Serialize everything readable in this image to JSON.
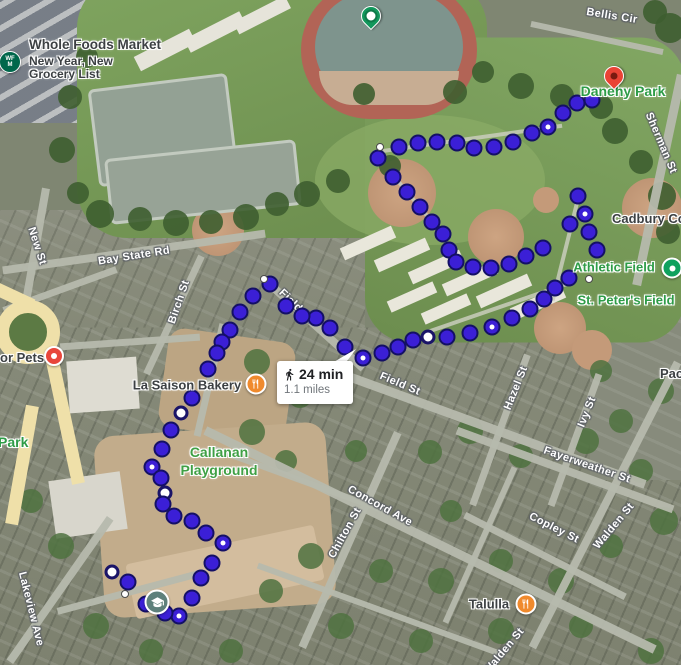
{
  "pois": {
    "whole_foods": {
      "title": "Whole Foods Market",
      "subtitle1": "New Year, New",
      "subtitle2": "Grocery List"
    },
    "danehy_park": {
      "label": "Danehy Park"
    },
    "cadbury": {
      "label": "Cadbury Co"
    },
    "athletic_field": {
      "label": "Athletic Field"
    },
    "st_peters_field": {
      "label": "St. Peter's Field"
    },
    "pac_partial": {
      "label": "Pac"
    },
    "pets_partial": {
      "label": "or Pets"
    },
    "park_partial": {
      "label": "Park"
    },
    "la_saison": {
      "label": "La Saison Bakery"
    },
    "callanan": {
      "line1": "Callanan",
      "line2": "Playground"
    },
    "talulla": {
      "label": "Talulla"
    }
  },
  "route": {
    "tooltip": {
      "mode": "walking",
      "duration": "24 min",
      "distance": "1.1 miles"
    },
    "dots": [
      [
        378,
        158,
        "b"
      ],
      [
        399,
        147,
        "b"
      ],
      [
        418,
        143,
        "b"
      ],
      [
        437,
        142,
        "b"
      ],
      [
        457,
        143,
        "b"
      ],
      [
        474,
        148,
        "b"
      ],
      [
        494,
        147,
        "b"
      ],
      [
        513,
        142,
        "b"
      ],
      [
        532,
        133,
        "b"
      ],
      [
        548,
        127,
        "wc"
      ],
      [
        563,
        113,
        "b"
      ],
      [
        577,
        103,
        "b"
      ],
      [
        592,
        100,
        "b"
      ],
      [
        380,
        147,
        "sw"
      ],
      [
        393,
        177,
        "b"
      ],
      [
        407,
        192,
        "b"
      ],
      [
        420,
        207,
        "b"
      ],
      [
        432,
        222,
        "b"
      ],
      [
        443,
        234,
        "b"
      ],
      [
        449,
        250,
        "b"
      ],
      [
        456,
        262,
        "b"
      ],
      [
        473,
        267,
        "b"
      ],
      [
        491,
        268,
        "b"
      ],
      [
        509,
        264,
        "b"
      ],
      [
        526,
        256,
        "b"
      ],
      [
        543,
        248,
        "b"
      ],
      [
        578,
        196,
        "b"
      ],
      [
        585,
        214,
        "wc"
      ],
      [
        570,
        224,
        "b"
      ],
      [
        589,
        232,
        "b"
      ],
      [
        597,
        250,
        "b"
      ],
      [
        589,
        279,
        "sw"
      ],
      [
        569,
        278,
        "b"
      ],
      [
        555,
        288,
        "b"
      ],
      [
        544,
        299,
        "b"
      ],
      [
        530,
        309,
        "b"
      ],
      [
        512,
        318,
        "b"
      ],
      [
        492,
        327,
        "wc"
      ],
      [
        470,
        333,
        "b"
      ],
      [
        447,
        337,
        "b"
      ],
      [
        428,
        337,
        "ring"
      ],
      [
        413,
        340,
        "b"
      ],
      [
        398,
        347,
        "b"
      ],
      [
        382,
        353,
        "b"
      ],
      [
        363,
        358,
        "wc"
      ],
      [
        345,
        347,
        "b"
      ],
      [
        330,
        328,
        "b"
      ],
      [
        316,
        318,
        "b"
      ],
      [
        302,
        316,
        "b"
      ],
      [
        286,
        306,
        "b"
      ],
      [
        270,
        284,
        "b"
      ],
      [
        264,
        279,
        "sw"
      ],
      [
        253,
        296,
        "b"
      ],
      [
        240,
        312,
        "b"
      ],
      [
        230,
        330,
        "b"
      ],
      [
        222,
        342,
        "b"
      ],
      [
        217,
        353,
        "b"
      ],
      [
        208,
        369,
        "b"
      ],
      [
        192,
        398,
        "b"
      ],
      [
        181,
        413,
        "ring"
      ],
      [
        171,
        430,
        "b"
      ],
      [
        162,
        449,
        "b"
      ],
      [
        152,
        467,
        "wc"
      ],
      [
        161,
        478,
        "b"
      ],
      [
        165,
        493,
        "ring"
      ],
      [
        163,
        504,
        "b"
      ],
      [
        174,
        516,
        "b"
      ],
      [
        192,
        521,
        "b"
      ],
      [
        206,
        533,
        "b"
      ],
      [
        223,
        543,
        "wc"
      ],
      [
        212,
        563,
        "b"
      ],
      [
        201,
        578,
        "b"
      ],
      [
        192,
        598,
        "b"
      ],
      [
        179,
        616,
        "wc"
      ],
      [
        165,
        613,
        "b"
      ],
      [
        146,
        604,
        "b"
      ],
      [
        128,
        582,
        "b"
      ],
      [
        112,
        572,
        "ring"
      ],
      [
        125,
        594,
        "sw"
      ]
    ]
  },
  "streets": [
    {
      "label": "Bellis Cir",
      "x": 612,
      "y": 16,
      "rot": 9
    },
    {
      "label": "Sherman St",
      "x": 661,
      "y": 143,
      "rot": 67
    },
    {
      "label": "Bay State Rd",
      "x": 134,
      "y": 256,
      "rot": -9
    },
    {
      "label": "New St",
      "x": 37,
      "y": 246,
      "rot": 72
    },
    {
      "label": "Birch St",
      "x": 179,
      "y": 302,
      "rot": -71
    },
    {
      "label": "Field St",
      "x": 296,
      "y": 306,
      "rot": 44
    },
    {
      "label": "Field St",
      "x": 400,
      "y": 384,
      "rot": 23
    },
    {
      "label": "Hazel St",
      "x": 516,
      "y": 388,
      "rot": -68
    },
    {
      "label": "Ivy St",
      "x": 587,
      "y": 412,
      "rot": -68
    },
    {
      "label": "Fayerweather St",
      "x": 587,
      "y": 465,
      "rot": 19
    },
    {
      "label": "Copley St",
      "x": 554,
      "y": 528,
      "rot": 27
    },
    {
      "label": "Walden St",
      "x": 614,
      "y": 526,
      "rot": -50
    },
    {
      "label": "Walden St",
      "x": 504,
      "y": 651,
      "rot": -50
    },
    {
      "label": "Concord Ave",
      "x": 380,
      "y": 506,
      "rot": 29
    },
    {
      "label": "Chilton St",
      "x": 345,
      "y": 533,
      "rot": -61
    },
    {
      "label": "Lakeview Ave",
      "x": 31,
      "y": 609,
      "rot": 76
    }
  ],
  "colors": {
    "route_dot": "#3B1FD6",
    "route_dot_border": "#141065",
    "food_marker": "#F08A2D",
    "school_marker": "#5E807B",
    "pets_marker": "#E8463B",
    "park_pin": "#12975C",
    "danehy_pin": "#EA4335",
    "athletic_marker": "#0FA15E",
    "park_label": "#2E9C47",
    "street_label": "#FFFFFF",
    "poi_label": "#3C4043",
    "whole_foods_brand": "#00674B"
  }
}
